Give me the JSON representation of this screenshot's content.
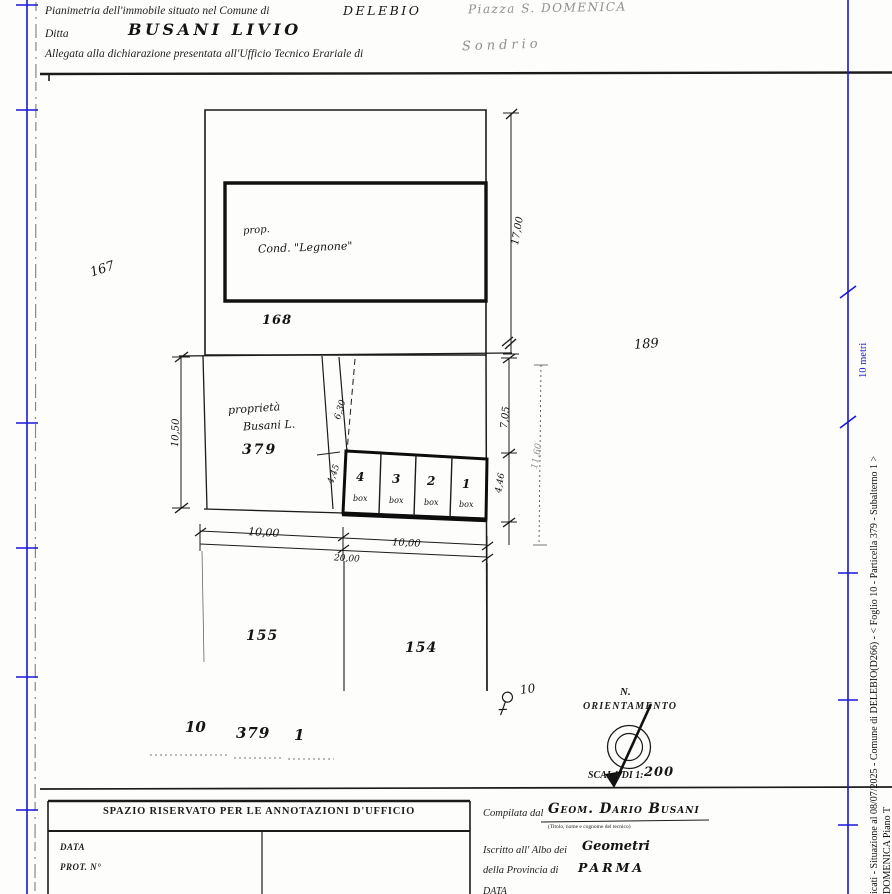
{
  "colors": {
    "ink": "#1b1b1b",
    "blue": "#1a17d6",
    "faint": "#8f8f8f"
  },
  "header": {
    "title_label": "Pianimetria dell'immobile situato nel Comune di",
    "comune_value": "DELEBIO",
    "address_value": "Piazza  S. DOMENICA",
    "ditta_label": "Ditta",
    "ditta_value": "BUSANI  LIVIO",
    "allegata_label": "Allegata alla dichiarazione presentata all'Ufficio Tecnico Erariale di",
    "ufficio_value": "Sondrio"
  },
  "plan": {
    "building_label_1": "prop.",
    "building_label_2": "Cond. \"Legnone\"",
    "parcel_168": "168",
    "parcel_189": "189",
    "parcel_167": "167",
    "parcel_379": "379",
    "parcel_155": "155",
    "parcel_154": "154",
    "owner_label_1": "proprietà",
    "owner_label_2": "Busani L.",
    "boxes": [
      {
        "num": "4",
        "label": "box"
      },
      {
        "num": "3",
        "label": "box"
      },
      {
        "num": "2",
        "label": "box"
      },
      {
        "num": "1",
        "label": "box"
      }
    ],
    "dims": {
      "east_height": "17,00",
      "west_height": "10,50",
      "strip_upper": "6,30",
      "strip_lower": "4,45",
      "right_upper": "7,05",
      "right_lower": "4,46",
      "right_total": "11,60",
      "south_left": "10,00",
      "south_right": "10,00",
      "south_total": "20,00"
    },
    "point_label": "10",
    "refs": {
      "foglio": "10",
      "particella": "379",
      "subalterno": "1"
    },
    "north_label": "N.",
    "orientation_label": "ORIENTAMENTO",
    "scale_label": "SCALA DI 1:",
    "scale_value": "200"
  },
  "footer": {
    "annotations_title": "SPAZIO RISERVATO PER LE ANNOTAZIONI D'UFFICIO",
    "data_label": "DATA",
    "prot_label": "PROT. N°",
    "compilata_label": "Compilata dal",
    "compilata_value": "Geom. Dario Busani",
    "compilata_note": "(Titolo, nome e cognome del tecnico)",
    "iscritto_label": "Iscritto all' Albo dei",
    "iscritto_value": "Geometri",
    "provincia_label": "della Provincia di",
    "provincia_value": "PARMA",
    "data2_label": "DATA"
  },
  "sidebar": {
    "watermark_line1": "icati - Situazione al 08/07/2025 - Comune di DELEBIO(D266) - < Foglio 10 - Particella 379 - Subalterno 1 >",
    "watermark_line2": "DOMENICA Piano T",
    "scale_10m": "10 metri"
  }
}
